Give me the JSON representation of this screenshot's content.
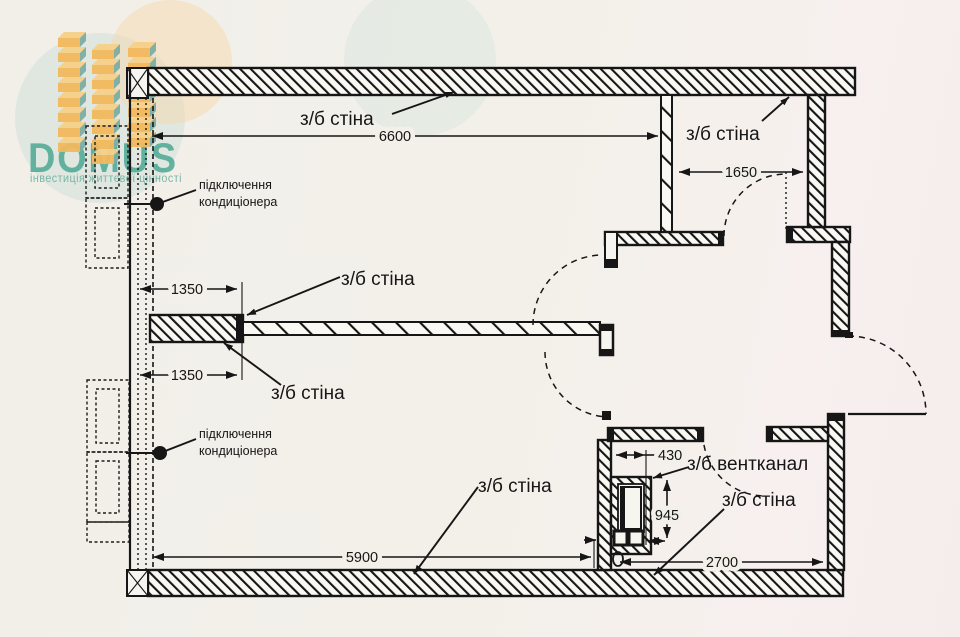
{
  "logo": {
    "brand": "DOMUS",
    "tagline": "інвестиція життєвої цінності"
  },
  "plan": {
    "wall_label": "з/б стіна",
    "vent_label": "з/б вентканал",
    "ac_label_line1": "підключення",
    "ac_label_line2": "кондиціонера"
  },
  "dimensions": {
    "top_span": "6600",
    "upper_right_span": "1650",
    "partition_upper": "1350",
    "partition_lower": "1350",
    "bottom_left_span": "5900",
    "bottom_right_span": "2700",
    "vent_width": "430",
    "vent_depth": "945"
  },
  "colors": {
    "paper": "#f3f0ea",
    "ink": "#161616",
    "brand_teal": "#3fa28d",
    "tagline_teal": "#74b4a5",
    "block_orange": "#f2b95e",
    "block_orange_top": "#f7d08a",
    "block_teal_side": "#7eada3",
    "watermark_teal": "#bcd9d2",
    "watermark_orange": "#f6d9ae"
  }
}
